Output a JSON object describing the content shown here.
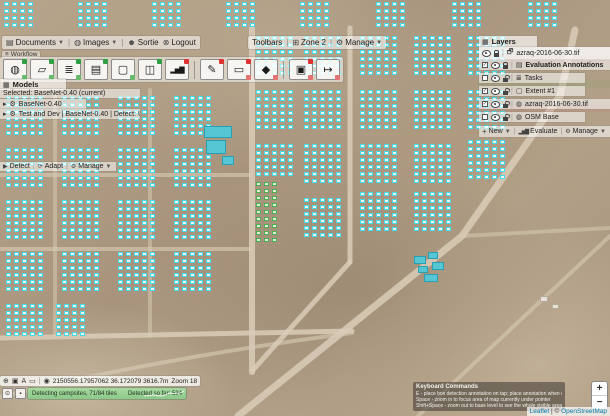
{
  "menubar": {
    "documents": "Documents",
    "images": "Images",
    "sortie": "Sortie",
    "logout": "Logout",
    "toolbars": "Toolbars",
    "zone": "Zone 2",
    "manage": "Manage"
  },
  "workflow_label": "Workflow",
  "toolbar": {
    "buttons": [
      {
        "name": "globe-tool",
        "glyph": "◍"
      },
      {
        "name": "polygon-draw-tool",
        "glyph": "▱"
      },
      {
        "name": "task-list-tool",
        "glyph": "≣"
      },
      {
        "name": "clipboard-tool",
        "glyph": "▤"
      },
      {
        "name": "box-select-tool",
        "glyph": "▢"
      },
      {
        "name": "binoculars-tool",
        "glyph": "◫"
      },
      {
        "name": "chart-tool",
        "glyph": "▂▅▇"
      },
      {
        "name": "pen-tool",
        "glyph": "✎"
      },
      {
        "name": "box-edit-tool",
        "glyph": "▭"
      },
      {
        "name": "training-tool",
        "glyph": "◆"
      },
      {
        "name": "box-remove-tool",
        "glyph": "▣"
      },
      {
        "name": "export-tool",
        "glyph": "↦"
      }
    ]
  },
  "models_panel": {
    "title": "Models",
    "selected_line": "Selected: BaseNet-0.40 (current)",
    "items": [
      {
        "label": "BaseNet-0.40"
      },
      {
        "label": "Test and Dev | BaseNet-0.40 | Detect: Use"
      }
    ],
    "footer": {
      "detect": "Detect",
      "adapt": "Adapt",
      "manage": "Manage"
    }
  },
  "layers_panel": {
    "title": "Layers",
    "rows": [
      {
        "label": "azraq-2016-06-30.tif"
      },
      {
        "label": "Evaluation Annotations"
      },
      {
        "label": "Tasks"
      },
      {
        "label": "Extent #1"
      },
      {
        "label": "azraq-2016-06-30.tif"
      },
      {
        "label": "OSM Base"
      }
    ],
    "footer": {
      "new": "New",
      "evaluate": "Evaluate",
      "manage": "Manage"
    }
  },
  "status_bar": {
    "coords": "2150556.17957062 36.172079 3616.7m",
    "zoom": "Zoom 18"
  },
  "progress": {
    "status": "Detecting campsites, 71/84 tiles",
    "detected": "Detected so far: 524"
  },
  "keyboard_help": {
    "title": "Keyboard Commands",
    "line1": "E - place box detection annotation on tap; place annotation when editing - remove it",
    "line2": "Space - zoom in to focus area of map currently under pointer",
    "line3": "Shift+Space - zoom out to base level to see the whole visible area"
  },
  "map_controls": {
    "zoom_in": "+",
    "zoom_out": "−"
  },
  "attribution": {
    "leaflet": "Leaflet",
    "separator": " | © ",
    "osm": "OpenStreetMap"
  },
  "colors": {
    "annotation_cyan": "#37daeb",
    "annotation_green": "#40ae49",
    "progress_green": "#8cc98a",
    "link_blue": "#0078a8"
  }
}
